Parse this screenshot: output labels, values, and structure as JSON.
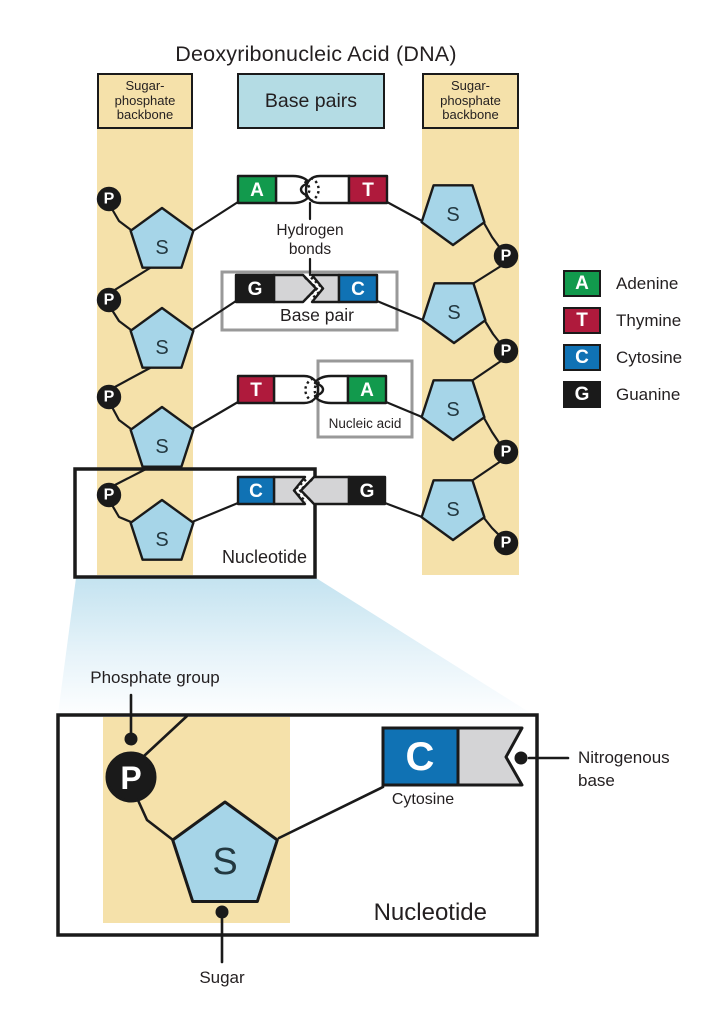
{
  "title": "Deoxyribonucleic Acid (DNA)",
  "header": {
    "left_backbone_lines": [
      "Sugar-",
      "phosphate",
      "backbone"
    ],
    "base_pairs_label": "Base pairs",
    "right_backbone_lines": [
      "Sugar-",
      "phosphate",
      "backbone"
    ]
  },
  "symbols": {
    "sugar": "S",
    "phosphate": "P"
  },
  "strand": {
    "rows": [
      {
        "left": "A",
        "right": "T"
      },
      {
        "left": "G",
        "right": "C"
      },
      {
        "left": "T",
        "right": "A"
      },
      {
        "left": "C",
        "right": "G"
      }
    ]
  },
  "annotations": {
    "hydrogen_bonds_lines": [
      "Hydrogen",
      "bonds"
    ],
    "base_pair": "Base pair",
    "nucleic_acid": "Nucleic acid",
    "nucleotide": "Nucleotide",
    "phosphate_group": "Phosphate group",
    "sugar": "Sugar",
    "cytosine": "Cytosine",
    "nitrogenous_base_lines": [
      "Nitrogenous",
      "base"
    ],
    "nucleotide_large": "Nucleotide",
    "detail_base_letter": "C"
  },
  "legend": [
    {
      "letter": "A",
      "name": "Adenine",
      "color": "#129A4D"
    },
    {
      "letter": "T",
      "name": "Thymine",
      "color": "#AF1A3C"
    },
    {
      "letter": "C",
      "name": "Cytosine",
      "color": "#1072B4"
    },
    {
      "letter": "G",
      "name": "Guanine",
      "color": "#1A1A1A"
    }
  ],
  "colors": {
    "adenine": "#129A4D",
    "thymine": "#AF1A3C",
    "cytosine": "#1072B4",
    "guanine": "#1A1A1A",
    "backbone_band": "#F5E1AA",
    "base_pairs_header": "#B4DCE4",
    "sugar_fill": "#A6D5E8",
    "connector_gray": "#D4D4D6",
    "frame_gray": "#999999",
    "outline": "#1A1A1A"
  }
}
